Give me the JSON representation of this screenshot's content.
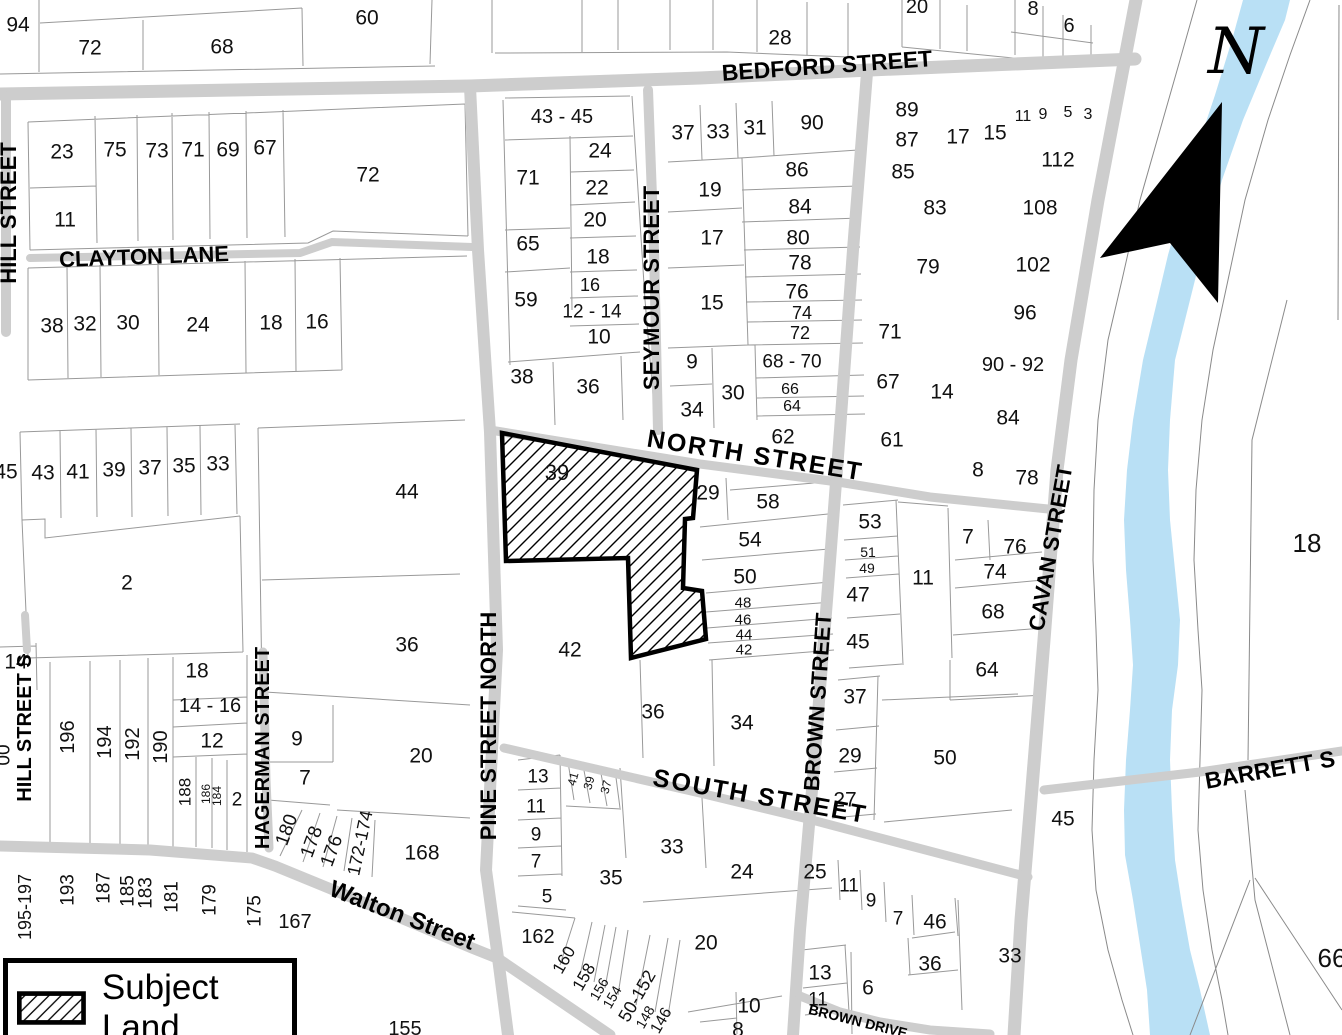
{
  "legend": {
    "label": "Subject Land"
  },
  "north_indicator": {
    "label": "N"
  },
  "subject_land": {
    "lot_number": "39"
  },
  "colors": {
    "river": "#b9e0f5",
    "road": "#cdcdcd",
    "parcel_line": "#999999",
    "subject_outline": "#000000"
  },
  "streets": [
    {
      "name": "BEDFORD STREET",
      "x": 827,
      "y": 66,
      "r": -4,
      "fs": 23
    },
    {
      "name": "CLAYTON LANE",
      "x": 144,
      "y": 257,
      "r": -2,
      "fs": 22
    },
    {
      "name": "HILL STREET",
      "x": 9,
      "y": 213,
      "r": -90,
      "fs": 22
    },
    {
      "name": "SEYMOUR STREET",
      "x": 652,
      "y": 288,
      "r": -90,
      "fs": 22
    },
    {
      "name": "NORTH STREET",
      "x": 755,
      "y": 456,
      "r": 9,
      "fs": 25,
      "ls": 2
    },
    {
      "name": "PINE STREET NORTH",
      "x": 489,
      "y": 726,
      "r": -90,
      "fs": 22
    },
    {
      "name": "HAGERMAN STREET",
      "x": 263,
      "y": 748,
      "r": -90,
      "fs": 20
    },
    {
      "name": "BROWN STREET",
      "x": 818,
      "y": 702,
      "r": -86,
      "fs": 22
    },
    {
      "name": "CAVAN STREET",
      "x": 1051,
      "y": 548,
      "r": -80,
      "fs": 22
    },
    {
      "name": "SOUTH STREET",
      "x": 760,
      "y": 797,
      "r": 10,
      "fs": 25,
      "ls": 2
    },
    {
      "name": "Walton Street",
      "x": 402,
      "y": 916,
      "r": 21,
      "fs": 24
    },
    {
      "name": "BARRETT S",
      "x": 1270,
      "y": 770,
      "r": -10,
      "fs": 23
    },
    {
      "name": "HILL STREET S",
      "x": 25,
      "y": 728,
      "r": -90,
      "fs": 20
    },
    {
      "name": "BROWN DRIVE",
      "x": 858,
      "y": 1021,
      "r": 14,
      "fs": 14
    }
  ],
  "lots": [
    {
      "n": "94",
      "x": 18,
      "y": 25
    },
    {
      "n": "72",
      "x": 90,
      "y": 48
    },
    {
      "n": "68",
      "x": 222,
      "y": 47
    },
    {
      "n": "60",
      "x": 367,
      "y": 18
    },
    {
      "n": "28",
      "x": 780,
      "y": 38
    },
    {
      "n": "20",
      "x": 917,
      "y": 7,
      "fs": 20
    },
    {
      "n": "8",
      "x": 1033,
      "y": 9,
      "fs": 20
    },
    {
      "n": "6",
      "x": 1069,
      "y": 26,
      "fs": 20
    },
    {
      "n": "23",
      "x": 62,
      "y": 152
    },
    {
      "n": "75",
      "x": 115,
      "y": 150
    },
    {
      "n": "73",
      "x": 157,
      "y": 151
    },
    {
      "n": "71",
      "x": 193,
      "y": 150
    },
    {
      "n": "69",
      "x": 228,
      "y": 150
    },
    {
      "n": "67",
      "x": 265,
      "y": 148
    },
    {
      "n": "72",
      "x": 368,
      "y": 175
    },
    {
      "n": "11",
      "x": 65,
      "y": 220
    },
    {
      "n": "38",
      "x": 52,
      "y": 326
    },
    {
      "n": "32",
      "x": 85,
      "y": 324
    },
    {
      "n": "30",
      "x": 128,
      "y": 323
    },
    {
      "n": "24",
      "x": 198,
      "y": 325
    },
    {
      "n": "18",
      "x": 271,
      "y": 323
    },
    {
      "n": "16",
      "x": 317,
      "y": 322
    },
    {
      "n": "45",
      "x": 6,
      "y": 472
    },
    {
      "n": "43",
      "x": 43,
      "y": 473
    },
    {
      "n": "41",
      "x": 78,
      "y": 472
    },
    {
      "n": "39",
      "x": 114,
      "y": 470
    },
    {
      "n": "37",
      "x": 150,
      "y": 468
    },
    {
      "n": "35",
      "x": 184,
      "y": 466
    },
    {
      "n": "33",
      "x": 218,
      "y": 464
    },
    {
      "n": "44",
      "x": 407,
      "y": 492
    },
    {
      "n": "2",
      "x": 127,
      "y": 583
    },
    {
      "n": "36",
      "x": 407,
      "y": 645
    },
    {
      "n": "14",
      "x": 16,
      "y": 662
    },
    {
      "n": "18",
      "x": 197,
      "y": 671
    },
    {
      "n": "14 - 16",
      "x": 210,
      "y": 706,
      "fs": 20
    },
    {
      "n": "12",
      "x": 212,
      "y": 741
    },
    {
      "n": "9",
      "x": 297,
      "y": 739
    },
    {
      "n": "7",
      "x": 305,
      "y": 778
    },
    {
      "n": "20",
      "x": 421,
      "y": 756
    },
    {
      "n": "2",
      "x": 237,
      "y": 800,
      "fs": 19
    },
    {
      "n": "168",
      "x": 422,
      "y": 853
    },
    {
      "n": "196",
      "x": 68,
      "y": 737,
      "fs": 20,
      "r": -90
    },
    {
      "n": "194",
      "x": 105,
      "y": 742,
      "fs": 20,
      "r": -90
    },
    {
      "n": "192",
      "x": 133,
      "y": 744,
      "fs": 20,
      "r": -90
    },
    {
      "n": "190",
      "x": 161,
      "y": 747,
      "fs": 20,
      "r": -90
    },
    {
      "n": "188",
      "x": 185,
      "y": 792,
      "fs": 17,
      "r": -90
    },
    {
      "n": "186",
      "x": 206,
      "y": 794,
      "fs": 12,
      "r": -90
    },
    {
      "n": "184",
      "x": 217,
      "y": 796,
      "fs": 12,
      "r": -90
    },
    {
      "n": "180",
      "x": 287,
      "y": 830,
      "fs": 19,
      "r": -70
    },
    {
      "n": "178",
      "x": 312,
      "y": 842,
      "fs": 19,
      "r": -70
    },
    {
      "n": "176",
      "x": 332,
      "y": 851,
      "fs": 19,
      "r": -70
    },
    {
      "n": "172-174",
      "x": 360,
      "y": 843,
      "fs": 18,
      "r": -78
    },
    {
      "n": "195-197",
      "x": 25,
      "y": 907,
      "fs": 18,
      "r": -90
    },
    {
      "n": "193",
      "x": 68,
      "y": 890,
      "fs": 19,
      "r": -90
    },
    {
      "n": "187",
      "x": 104,
      "y": 888,
      "fs": 19,
      "r": -90
    },
    {
      "n": "185",
      "x": 128,
      "y": 891,
      "fs": 19,
      "r": -90
    },
    {
      "n": "183",
      "x": 146,
      "y": 893,
      "fs": 19,
      "r": -90
    },
    {
      "n": "181",
      "x": 172,
      "y": 897,
      "fs": 19,
      "r": -90
    },
    {
      "n": "179",
      "x": 210,
      "y": 900,
      "fs": 19,
      "r": -90
    },
    {
      "n": "175",
      "x": 255,
      "y": 911,
      "fs": 19,
      "r": -90
    },
    {
      "n": "167",
      "x": 295,
      "y": 922,
      "fs": 20
    },
    {
      "n": "155",
      "x": 405,
      "y": 1029,
      "fs": 20
    },
    {
      "n": "00",
      "x": 4,
      "y": 755,
      "fs": 19,
      "r": -90
    },
    {
      "n": "13",
      "x": 538,
      "y": 777,
      "fs": 19
    },
    {
      "n": "11",
      "x": 536,
      "y": 807,
      "fs": 19
    },
    {
      "n": "9",
      "x": 536,
      "y": 835,
      "fs": 19
    },
    {
      "n": "7",
      "x": 536,
      "y": 862,
      "fs": 19
    },
    {
      "n": "5",
      "x": 547,
      "y": 897,
      "fs": 19
    },
    {
      "n": "162",
      "x": 538,
      "y": 937,
      "fs": 20
    },
    {
      "n": "160",
      "x": 564,
      "y": 960,
      "fs": 17,
      "r": -60
    },
    {
      "n": "158",
      "x": 584,
      "y": 977,
      "fs": 17,
      "r": -60
    },
    {
      "n": "156",
      "x": 599,
      "y": 989,
      "fs": 14,
      "r": -60
    },
    {
      "n": "154",
      "x": 612,
      "y": 997,
      "fs": 14,
      "r": -60
    },
    {
      "n": "50-152",
      "x": 637,
      "y": 996,
      "fs": 18,
      "r": -60
    },
    {
      "n": "148",
      "x": 645,
      "y": 1017,
      "fs": 14,
      "r": -60
    },
    {
      "n": "146",
      "x": 662,
      "y": 1021,
      "fs": 16,
      "r": -60
    },
    {
      "n": "41",
      "x": 573,
      "y": 779,
      "fs": 12,
      "r": -75
    },
    {
      "n": "39",
      "x": 589,
      "y": 783,
      "fs": 12,
      "r": -75
    },
    {
      "n": "37",
      "x": 606,
      "y": 787,
      "fs": 12,
      "r": -75
    },
    {
      "n": "35",
      "x": 611,
      "y": 878
    },
    {
      "n": "33",
      "x": 672,
      "y": 847
    },
    {
      "n": "24",
      "x": 742,
      "y": 872
    },
    {
      "n": "20",
      "x": 706,
      "y": 943
    },
    {
      "n": "36",
      "x": 653,
      "y": 712
    },
    {
      "n": "34",
      "x": 742,
      "y": 723
    },
    {
      "n": "42",
      "x": 570,
      "y": 650
    },
    {
      "n": "43 - 45",
      "x": 562,
      "y": 117,
      "fs": 20
    },
    {
      "n": "71",
      "x": 528,
      "y": 178
    },
    {
      "n": "24",
      "x": 600,
      "y": 151
    },
    {
      "n": "22",
      "x": 597,
      "y": 188
    },
    {
      "n": "20",
      "x": 595,
      "y": 220
    },
    {
      "n": "65",
      "x": 528,
      "y": 244
    },
    {
      "n": "18",
      "x": 598,
      "y": 257
    },
    {
      "n": "16",
      "x": 590,
      "y": 285,
      "fs": 18
    },
    {
      "n": "59",
      "x": 526,
      "y": 300
    },
    {
      "n": "12 - 14",
      "x": 592,
      "y": 312,
      "fs": 19
    },
    {
      "n": "10",
      "x": 599,
      "y": 337
    },
    {
      "n": "38",
      "x": 522,
      "y": 377
    },
    {
      "n": "36",
      "x": 588,
      "y": 387
    },
    {
      "n": "39",
      "x": 557,
      "y": 473,
      "fs": 22
    },
    {
      "n": "37",
      "x": 683,
      "y": 133
    },
    {
      "n": "33",
      "x": 718,
      "y": 132
    },
    {
      "n": "31",
      "x": 755,
      "y": 128
    },
    {
      "n": "90",
      "x": 812,
      "y": 123
    },
    {
      "n": "19",
      "x": 710,
      "y": 190
    },
    {
      "n": "86",
      "x": 797,
      "y": 170
    },
    {
      "n": "84",
      "x": 800,
      "y": 207
    },
    {
      "n": "17",
      "x": 712,
      "y": 238
    },
    {
      "n": "80",
      "x": 798,
      "y": 238
    },
    {
      "n": "78",
      "x": 800,
      "y": 263
    },
    {
      "n": "76",
      "x": 797,
      "y": 292
    },
    {
      "n": "15",
      "x": 712,
      "y": 303
    },
    {
      "n": "74",
      "x": 802,
      "y": 313,
      "fs": 18
    },
    {
      "n": "72",
      "x": 800,
      "y": 333,
      "fs": 18
    },
    {
      "n": "9",
      "x": 692,
      "y": 362
    },
    {
      "n": "34",
      "x": 692,
      "y": 410
    },
    {
      "n": "30",
      "x": 733,
      "y": 393
    },
    {
      "n": "68 - 70",
      "x": 792,
      "y": 362,
      "fs": 19
    },
    {
      "n": "66",
      "x": 790,
      "y": 390,
      "fs": 16
    },
    {
      "n": "64",
      "x": 792,
      "y": 407,
      "fs": 16
    },
    {
      "n": "62",
      "x": 783,
      "y": 437
    },
    {
      "n": "29",
      "x": 708,
      "y": 493
    },
    {
      "n": "58",
      "x": 768,
      "y": 502
    },
    {
      "n": "54",
      "x": 750,
      "y": 540
    },
    {
      "n": "50",
      "x": 745,
      "y": 577
    },
    {
      "n": "48",
      "x": 743,
      "y": 603,
      "fs": 15
    },
    {
      "n": "46",
      "x": 743,
      "y": 620,
      "fs": 15
    },
    {
      "n": "44",
      "x": 744,
      "y": 635,
      "fs": 15
    },
    {
      "n": "42",
      "x": 744,
      "y": 650,
      "fs": 15
    },
    {
      "n": "89",
      "x": 907,
      "y": 110
    },
    {
      "n": "87",
      "x": 907,
      "y": 140
    },
    {
      "n": "85",
      "x": 903,
      "y": 172
    },
    {
      "n": "17",
      "x": 958,
      "y": 137
    },
    {
      "n": "15",
      "x": 995,
      "y": 133
    },
    {
      "n": "11",
      "x": 1023,
      "y": 117,
      "fs": 16
    },
    {
      "n": "9",
      "x": 1043,
      "y": 115,
      "fs": 16
    },
    {
      "n": "5",
      "x": 1068,
      "y": 113,
      "fs": 16
    },
    {
      "n": "3",
      "x": 1088,
      "y": 115,
      "fs": 16
    },
    {
      "n": "112",
      "x": 1058,
      "y": 160
    },
    {
      "n": "83",
      "x": 935,
      "y": 208
    },
    {
      "n": "108",
      "x": 1040,
      "y": 208
    },
    {
      "n": "79",
      "x": 928,
      "y": 267
    },
    {
      "n": "102",
      "x": 1033,
      "y": 265
    },
    {
      "n": "96",
      "x": 1025,
      "y": 313
    },
    {
      "n": "71",
      "x": 890,
      "y": 332
    },
    {
      "n": "67",
      "x": 888,
      "y": 382
    },
    {
      "n": "61",
      "x": 892,
      "y": 440
    },
    {
      "n": "14",
      "x": 942,
      "y": 392
    },
    {
      "n": "90 - 92",
      "x": 1013,
      "y": 365,
      "fs": 20
    },
    {
      "n": "84",
      "x": 1008,
      "y": 418
    },
    {
      "n": "8",
      "x": 978,
      "y": 470
    },
    {
      "n": "78",
      "x": 1027,
      "y": 478
    },
    {
      "n": "53",
      "x": 870,
      "y": 522
    },
    {
      "n": "51",
      "x": 868,
      "y": 552,
      "fs": 14
    },
    {
      "n": "49",
      "x": 867,
      "y": 568,
      "fs": 14
    },
    {
      "n": "47",
      "x": 858,
      "y": 595
    },
    {
      "n": "45",
      "x": 858,
      "y": 642
    },
    {
      "n": "11",
      "x": 923,
      "y": 578
    },
    {
      "n": "7",
      "x": 968,
      "y": 537
    },
    {
      "n": "76",
      "x": 1015,
      "y": 547
    },
    {
      "n": "74",
      "x": 995,
      "y": 572
    },
    {
      "n": "68",
      "x": 993,
      "y": 612
    },
    {
      "n": "64",
      "x": 987,
      "y": 670
    },
    {
      "n": "37",
      "x": 855,
      "y": 697
    },
    {
      "n": "29",
      "x": 850,
      "y": 756
    },
    {
      "n": "27",
      "x": 845,
      "y": 800
    },
    {
      "n": "50",
      "x": 945,
      "y": 758
    },
    {
      "n": "45",
      "x": 1063,
      "y": 819
    },
    {
      "n": "25",
      "x": 815,
      "y": 872
    },
    {
      "n": "11",
      "x": 849,
      "y": 886,
      "fs": 19
    },
    {
      "n": "9",
      "x": 871,
      "y": 901,
      "fs": 19
    },
    {
      "n": "7",
      "x": 898,
      "y": 919,
      "fs": 19
    },
    {
      "n": "46",
      "x": 935,
      "y": 922
    },
    {
      "n": "36",
      "x": 930,
      "y": 964
    },
    {
      "n": "13",
      "x": 820,
      "y": 973
    },
    {
      "n": "11",
      "x": 818,
      "y": 1000,
      "fs": 19
    },
    {
      "n": "6",
      "x": 868,
      "y": 988
    },
    {
      "n": "10",
      "x": 749,
      "y": 1006
    },
    {
      "n": "8",
      "x": 738,
      "y": 1030
    },
    {
      "n": "33",
      "x": 1010,
      "y": 956
    },
    {
      "n": "18",
      "x": 1307,
      "y": 543,
      "fs": 26
    },
    {
      "n": "66",
      "x": 1332,
      "y": 958,
      "fs": 26
    }
  ]
}
